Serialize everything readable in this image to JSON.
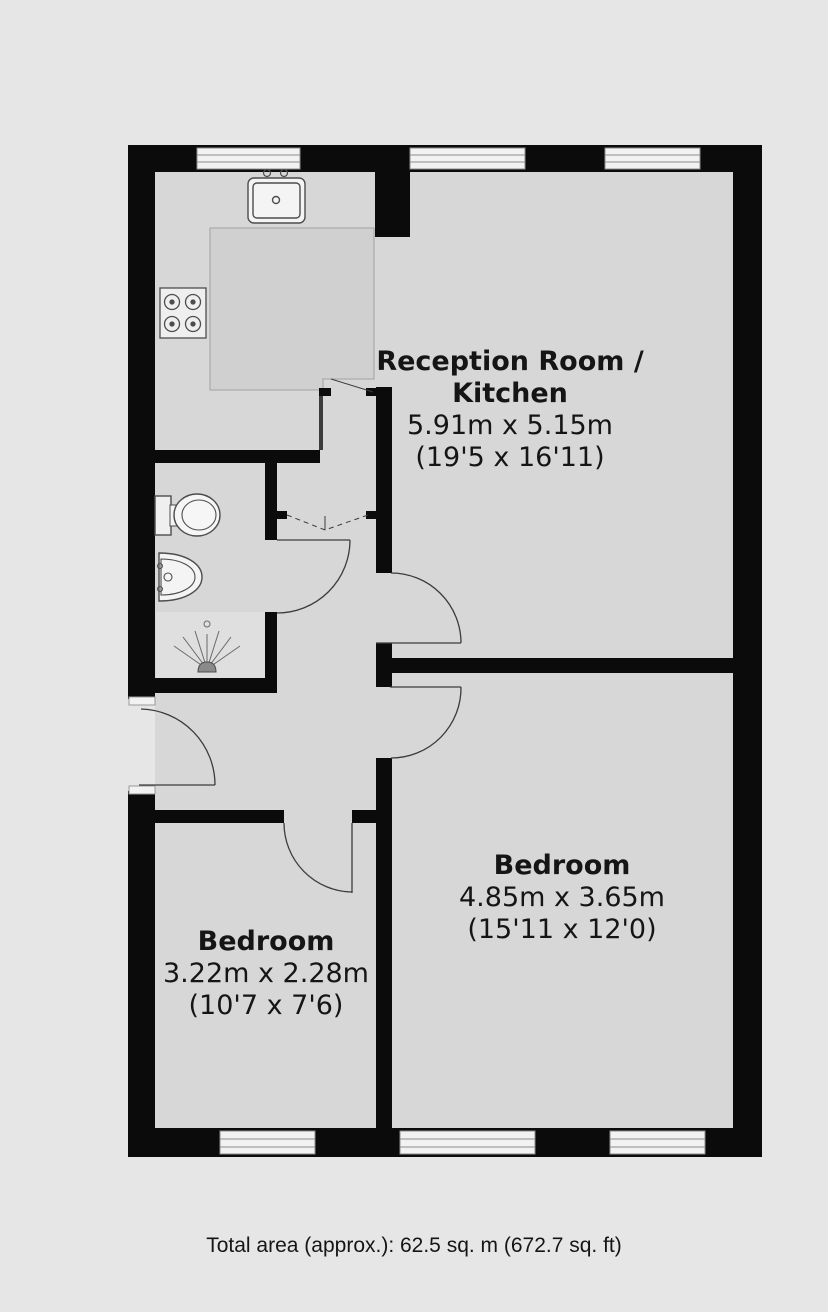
{
  "colors": {
    "page_background": "#e6e6e6",
    "floor": "#d7d7d7",
    "counter": "#d0d0d0",
    "wall": "#0b0b0b",
    "window_fill": "#f2f2f2",
    "window_frame": "#8c8c8c",
    "fixture_stroke": "#4d4d4d",
    "door_line": "#3c3c3c",
    "text": "#151515"
  },
  "rooms": [
    {
      "name": "Reception Room / Kitchen",
      "name_line1": "Reception Room /",
      "name_line2": "Kitchen",
      "dimensions_metric": "5.91m x 5.15m",
      "dimensions_imperial": "(19'5 x 16'11)"
    },
    {
      "name": "Bedroom",
      "dimensions_metric": "4.85m x 3.65m",
      "dimensions_imperial": "(15'11 x 12'0)"
    },
    {
      "name": "Bedroom",
      "dimensions_metric": "3.22m x 2.28m",
      "dimensions_imperial": "(10'7 x 7'6)"
    }
  ],
  "footer": {
    "total_area": "Total area (approx.): 62.5 sq. m (672.7 sq. ft)"
  },
  "fixtures": {
    "icons": [
      "sink-icon",
      "hob-icon",
      "toilet-icon",
      "basin-icon",
      "shower-icon"
    ],
    "doors": [
      "entrance-door",
      "bathroom-door",
      "reception-door",
      "bedroom-large-door",
      "bedroom-small-door",
      "kitchen-doorway",
      "folding-door"
    ]
  }
}
